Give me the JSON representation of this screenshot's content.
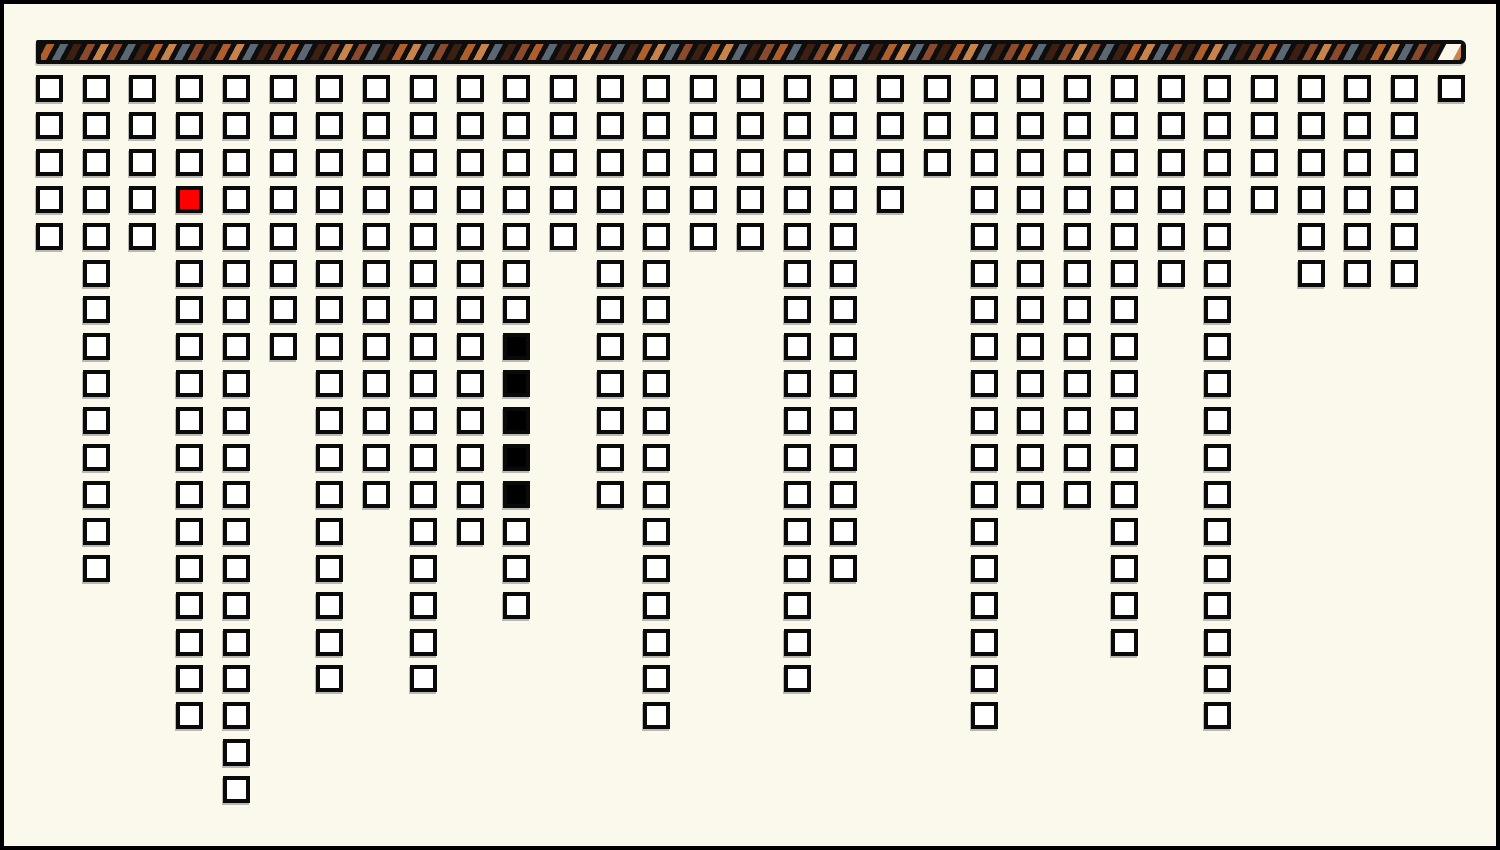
{
  "window": {
    "width": 1500,
    "height": 850,
    "background": "#FAF9EC",
    "frame_color": "#000000",
    "frame_thickness": 4
  },
  "progress_bar": {
    "x": 36,
    "y": 40,
    "width": 1430,
    "height": 24,
    "base_color": "#0D0D0D",
    "stripe_width": 7,
    "stripe_gap": 5,
    "stripe_angle_deg": 118,
    "stripe_sequence": [
      "#AF5E2C",
      "#5B6772",
      "#3E2013",
      "#8A4A2B",
      "#C8834A",
      "#8A4A2B",
      "#5B6772",
      "#3E2013",
      "#AF5E2C",
      "#C8834A",
      "#5B6772",
      "#8A4A2B",
      "#3E2013",
      "#AF5E2C",
      "#C8834A",
      "#5B6772",
      "#3E2013",
      "#8A4A2B"
    ],
    "remaining_segment_color": "#FAF7E8",
    "remaining_segment_width": 15,
    "remaining_segment_right_offset": 9,
    "corner_radius_right": 6
  },
  "grid": {
    "origin_x": 36,
    "origin_y": 75,
    "col_spacing": 46.73,
    "row_spacing": 36.9,
    "square_size": 27,
    "square_border_width": 4,
    "square_border_color": "#0A0A0A",
    "square_fill": "#FFFFFF",
    "num_columns": 31,
    "column_heights": [
      5,
      14,
      5,
      18,
      20,
      8,
      17,
      12,
      17,
      13,
      15,
      5,
      12,
      18,
      5,
      5,
      17,
      14,
      4,
      3,
      18,
      12,
      12,
      16,
      6,
      18,
      4,
      6,
      6,
      6,
      1
    ],
    "red_cells": [
      {
        "col": 4,
        "row": 4,
        "fill": "#FF0000"
      }
    ],
    "black_cells": [
      {
        "col": 11,
        "row": 8,
        "fill": "#000000"
      },
      {
        "col": 11,
        "row": 9,
        "fill": "#000000"
      },
      {
        "col": 11,
        "row": 10,
        "fill": "#000000"
      },
      {
        "col": 11,
        "row": 11,
        "fill": "#000000"
      },
      {
        "col": 11,
        "row": 12,
        "fill": "#000000"
      }
    ]
  },
  "chart_data": {
    "type": "unit_column",
    "categories": [
      1,
      2,
      3,
      4,
      5,
      6,
      7,
      8,
      9,
      10,
      11,
      12,
      13,
      14,
      15,
      16,
      17,
      18,
      19,
      20,
      21,
      22,
      23,
      24,
      25,
      26,
      27,
      28,
      29,
      30,
      31
    ],
    "values": [
      5,
      14,
      5,
      18,
      20,
      8,
      17,
      12,
      17,
      13,
      15,
      5,
      12,
      18,
      5,
      5,
      17,
      14,
      4,
      3,
      18,
      12,
      12,
      16,
      6,
      18,
      4,
      6,
      6,
      6,
      1
    ],
    "title": "",
    "xlabel": "",
    "ylabel": "",
    "ylim": [
      0,
      20
    ],
    "legend": [],
    "grid_lines": false,
    "orientation": "columns-hang-from-top",
    "annotations": {
      "red_unit": {
        "column": 4,
        "row_from_top": 4
      },
      "black_units": {
        "column": 11,
        "rows_from_top": [
          8,
          9,
          10,
          11,
          12
        ]
      },
      "total_units": 332
    }
  }
}
